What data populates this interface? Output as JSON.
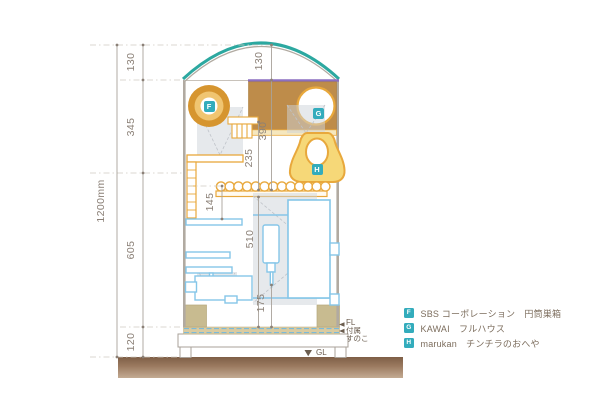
{
  "drawing": {
    "overall_height": "1200mm",
    "segments": {
      "arch": "130",
      "upper": "345",
      "middle": "605",
      "base": "120"
    },
    "internal": {
      "arch_height": "130",
      "box_drop": "390",
      "ladder_drop": "235",
      "shelf_gap": "145",
      "perch_to_floor": "510",
      "bottle_height": "175"
    },
    "markers": {
      "fl": "FL",
      "sunoko_line1": "付属",
      "sunoko_line2": "すのこ",
      "gl": "GL"
    }
  },
  "tags": {
    "f": "F",
    "g": "G",
    "h": "H"
  },
  "legend": {
    "items": [
      {
        "tag": "F",
        "text": "SBS コーポレーション　円筒巣箱"
      },
      {
        "tag": "G",
        "text": "KAWAI　フルハウス"
      },
      {
        "tag": "H",
        "text": "marukan　チンチラのおへや"
      }
    ]
  },
  "colors": {
    "arch_teal": "#2ca8a0",
    "purple_bar": "#8c6fc0",
    "orange_wood": "#e8a83c",
    "nest_ring": "#d6952f",
    "box_brown": "#be8c4a",
    "house_yellow": "#f6d878",
    "fixture_blue": "#85c6e8",
    "khaki_tray": "#c8bb90",
    "floor_tan": "#d9cba1",
    "ground_brown": "#8a6a50",
    "tag_teal": "#33acbc",
    "dim_text": "#8b8077"
  }
}
